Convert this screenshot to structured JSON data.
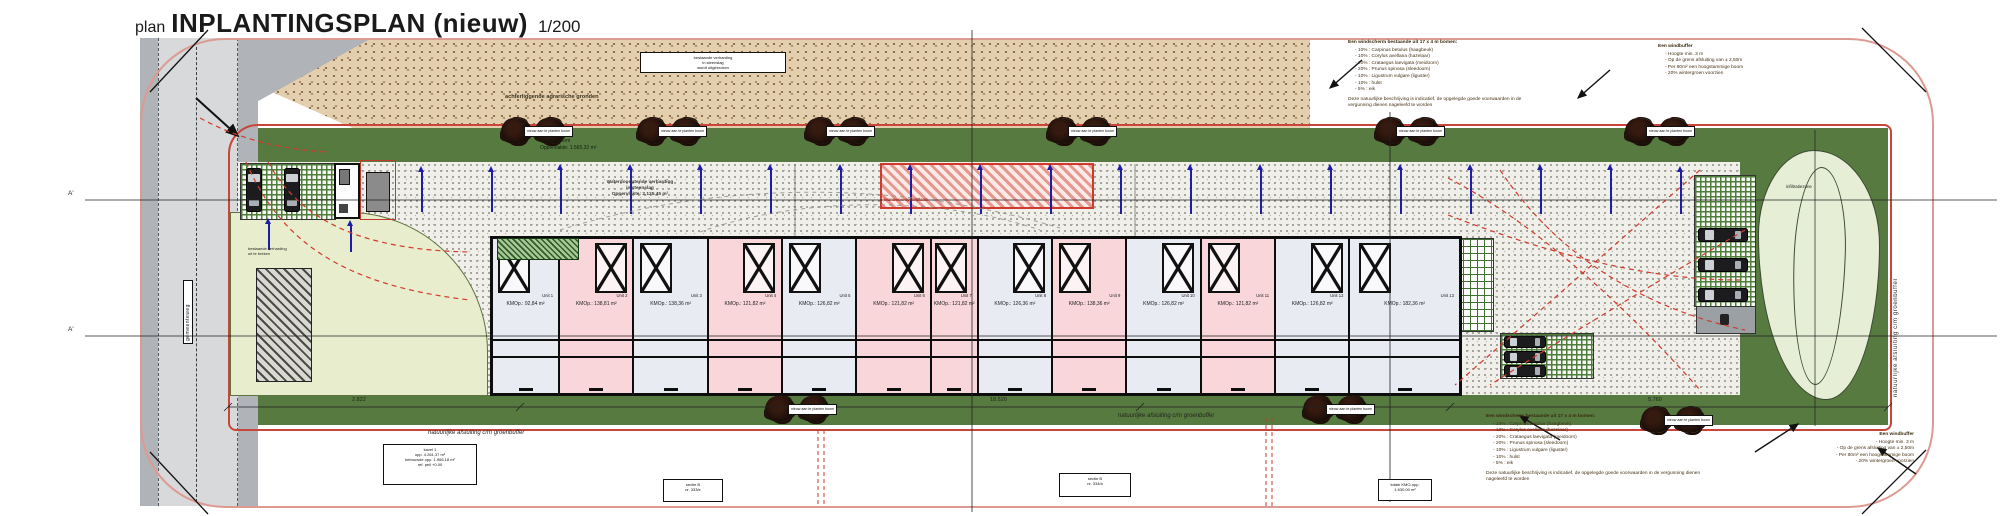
{
  "title": {
    "prefix": "plan",
    "main": "INPLANTINGSPLAN (nieuw)",
    "scale": "1/200"
  },
  "colors": {
    "boundary": "#c9453a",
    "boundary_light": "#dd9a93",
    "green_dark": "#567a40",
    "pink_unit": "#f8d6da",
    "grey_unit": "#e9ebf3",
    "tan": "#e3cfae",
    "blue_arrow": "#1d1da8",
    "red_marking": "#cf3a2d",
    "pond": "#e6eed6"
  },
  "annotations": {
    "planting": {
      "heading": "Een windscherm bestaande uit 17 x 4 m bomen:",
      "items": [
        "10% : Carpinus betulus (haagbeuk)",
        "10% : Corylus avellana (hazelaar)",
        "20% : Crataegus laevigata (meidoorn)",
        "20% : Prunus spinosa (sleedoorn)",
        "10% : Ligustrum vulgare (liguster)",
        "10% : hulst",
        "5% : eik"
      ],
      "note": "Deze natuurlijke beschrijving is indicatief, de opgelegde goede voorwaarden in de vergunning dienen nageleefd te worden"
    },
    "buffer": {
      "heading": "Een windbuffer",
      "items": [
        "Hoogte min. 3 m",
        "Op de grens afsluiting van ± 2,50m",
        "Per 80m² een hoogstammige boom",
        "20% wintergroen voorzien"
      ]
    }
  },
  "site_labels": {
    "agrarian": "achterliggende agrarische gronden",
    "existing_paving": [
      "bestaande verharding",
      "in steenslag",
      "wordt uitgebroken"
    ],
    "green_screen": [
      "Groenscherm",
      "Oppervlakte: 1.565,32 m²"
    ],
    "permeable_paving": [
      "Waterdoorlatende verharding",
      "in steenslag",
      "Oppervlakte: 2.125,45 m²"
    ],
    "fire_zone": "brandweeropstelplaats",
    "tree_tag": "nieuw aan te planten boom",
    "natural_border": "natuurlijke afsluiting c/m groenbuffer",
    "demolish": [
      "bestaande verharding",
      "uit te breken"
    ],
    "pond": "infiltratiezone",
    "road": "gemeenteweg",
    "section_a": "A'"
  },
  "dimensions": {
    "d1": "2.822",
    "d2": "18.520",
    "d3": "5.760"
  },
  "info_boxes": [
    {
      "lines": [
        "kavel 1",
        "opp. 4.261,37 m²",
        "bebouwde opp. 1.966,18 m²",
        "ref. peil +0.00"
      ]
    },
    {
      "lines": [
        "sectie B",
        "nr. 333/e"
      ]
    },
    {
      "lines": [
        "sectie B",
        "nr. 334/a"
      ]
    },
    {
      "lines": [
        "totale KMO-opp.",
        "1.630,00 m²"
      ]
    }
  ],
  "building": {
    "units": [
      {
        "unit": "Unit 1",
        "area": "KMOp.: 92,84 m²",
        "type": "grey"
      },
      {
        "unit": "Unit 2",
        "area": "KMOp.: 138,81 m²",
        "type": "pink"
      },
      {
        "unit": "Unit 3",
        "area": "KMOp.: 138,36 m²",
        "type": "grey"
      },
      {
        "unit": "Unit 4",
        "area": "KMOp.: 121,82 m²",
        "type": "pink"
      },
      {
        "unit": "Unit 5",
        "area": "KMOp.: 126,82 m²",
        "type": "grey"
      },
      {
        "unit": "Unit 6",
        "area": "KMOp.: 121,82 m²",
        "type": "pink"
      },
      {
        "unit": "Unit 7",
        "area": "KMOp.: 121,82 m²",
        "type": "pink"
      },
      {
        "unit": "Unit 8",
        "area": "KMOp.: 126,36 m²",
        "type": "grey"
      },
      {
        "unit": "Unit 9",
        "area": "KMOp.: 138,36 m²",
        "type": "pink"
      },
      {
        "unit": "Unit 10",
        "area": "KMOp.: 126,82 m²",
        "type": "grey"
      },
      {
        "unit": "Unit 11",
        "area": "KMOp.: 121,82 m²",
        "type": "pink"
      },
      {
        "unit": "Unit 12",
        "area": "KMOp.: 126,82 m²",
        "type": "grey"
      },
      {
        "unit": "Unit 13",
        "area": "KMOp.: 182,36 m²",
        "type": "grey"
      }
    ]
  }
}
